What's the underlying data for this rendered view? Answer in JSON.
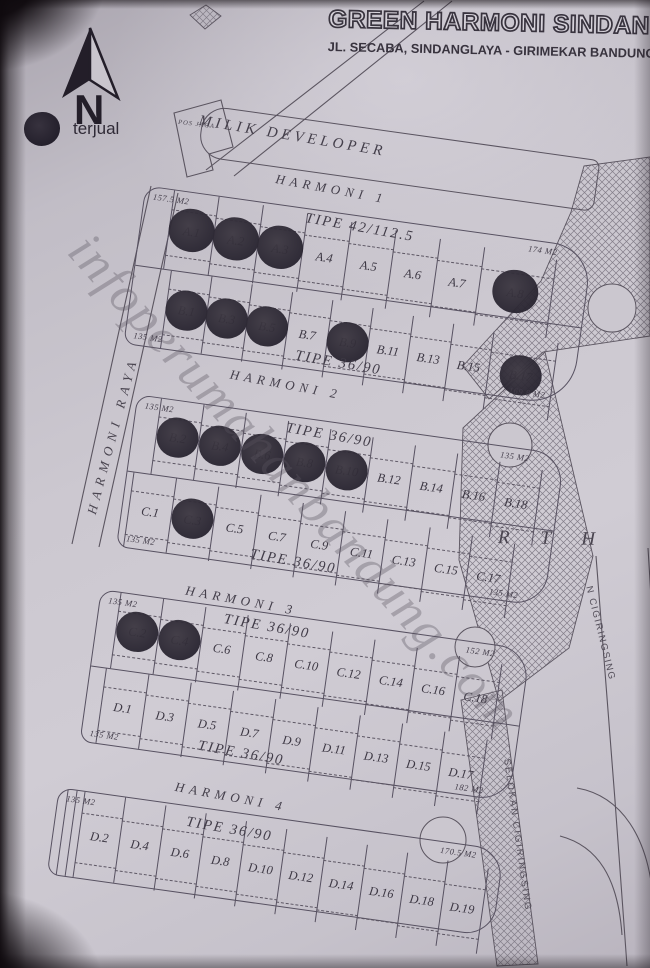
{
  "header": {
    "title": "GREEN HARMONI SINDANGLAYA",
    "subtitle": "JL. SECABA, SINDANGLAYA - GIRIMEKAR BANDUNG"
  },
  "compass": {
    "label": "N"
  },
  "legend": {
    "sold": "terjual"
  },
  "watermark": "infoperumahanbandung.com",
  "landmarks": {
    "pos_jaga": "POS JAGA",
    "developer_strip": "MILIK DEVELOPER",
    "left_road": "HARMONI RAYA",
    "green_space": "R T H",
    "right_road": "N CIGIRINGSING",
    "drain": "SELOKAN CIGIRINGSING"
  },
  "blocks": [
    {
      "street": "HARMONI 1",
      "rows": [
        {
          "tipe": "TIPE 42/112.5",
          "area_left": "157.5 M2",
          "area_right": "174 M2",
          "plots": [
            {
              "label": "A.1",
              "sold": true
            },
            {
              "label": "A.2",
              "sold": true
            },
            {
              "label": "A.3",
              "sold": true
            },
            {
              "label": "A.4",
              "sold": false
            },
            {
              "label": "A.5",
              "sold": false
            },
            {
              "label": "A.6",
              "sold": false
            },
            {
              "label": "A.7",
              "sold": false
            },
            {
              "label": "A.8",
              "sold": true
            }
          ]
        },
        {
          "tipe": "TIPE 36/90",
          "area_left": "135 M2",
          "area_right": "169.8 M2",
          "plots": [
            {
              "label": "B.1",
              "sold": true
            },
            {
              "label": "B.3",
              "sold": true
            },
            {
              "label": "B.5",
              "sold": true
            },
            {
              "label": "B.7",
              "sold": false
            },
            {
              "label": "B.9",
              "sold": true
            },
            {
              "label": "B.11",
              "sold": false
            },
            {
              "label": "B.13",
              "sold": false
            },
            {
              "label": "B.15",
              "sold": false
            },
            {
              "label": "B.17",
              "sold": true
            }
          ]
        }
      ]
    },
    {
      "street": "HARMONI 2",
      "rows": [
        {
          "tipe": "TIPE 36/90",
          "area_left": "135 M2",
          "area_right": "135 M2",
          "plots": [
            {
              "label": "B.2",
              "sold": true
            },
            {
              "label": "B.4",
              "sold": true
            },
            {
              "label": "B.6",
              "sold": true
            },
            {
              "label": "B.8",
              "sold": true
            },
            {
              "label": "B.10",
              "sold": true
            },
            {
              "label": "B.12",
              "sold": false
            },
            {
              "label": "B.14",
              "sold": false
            },
            {
              "label": "B.16",
              "sold": false
            },
            {
              "label": "B.18",
              "sold": false
            }
          ]
        },
        {
          "tipe": "TIPE 36/90",
          "area_left": "135 M2",
          "area_right": "135 M2",
          "plots": [
            {
              "label": "C.1",
              "sold": false
            },
            {
              "label": "C.3",
              "sold": true
            },
            {
              "label": "C.5",
              "sold": false
            },
            {
              "label": "C.7",
              "sold": false
            },
            {
              "label": "C.9",
              "sold": false
            },
            {
              "label": "C.11",
              "sold": false
            },
            {
              "label": "C.13",
              "sold": false
            },
            {
              "label": "C.15",
              "sold": false
            },
            {
              "label": "C.17",
              "sold": false
            }
          ]
        }
      ]
    },
    {
      "street": "HARMONI 3",
      "rows": [
        {
          "tipe": "TIPE 36/90",
          "area_left": "135 M2",
          "area_right": "152 M2",
          "plots": [
            {
              "label": "C.2",
              "sold": true
            },
            {
              "label": "C.4",
              "sold": true
            },
            {
              "label": "C.6",
              "sold": false
            },
            {
              "label": "C.8",
              "sold": false
            },
            {
              "label": "C.10",
              "sold": false
            },
            {
              "label": "C.12",
              "sold": false
            },
            {
              "label": "C.14",
              "sold": false
            },
            {
              "label": "C.16",
              "sold": false
            },
            {
              "label": "C.18",
              "sold": false
            }
          ]
        },
        {
          "tipe": "TIPE 36/90",
          "area_left": "135 M2",
          "area_right": "182 M2",
          "plots": [
            {
              "label": "D.1",
              "sold": false
            },
            {
              "label": "D.3",
              "sold": false
            },
            {
              "label": "D.5",
              "sold": false
            },
            {
              "label": "D.7",
              "sold": false
            },
            {
              "label": "D.9",
              "sold": false
            },
            {
              "label": "D.11",
              "sold": false
            },
            {
              "label": "D.13",
              "sold": false
            },
            {
              "label": "D.15",
              "sold": false
            },
            {
              "label": "D.17",
              "sold": false
            }
          ]
        }
      ]
    },
    {
      "street": "HARMONI 4",
      "rows": [
        {
          "tipe": "TIPE 36/90",
          "area_left": "135 M2",
          "area_right": "170.5 M2",
          "plots": [
            {
              "label": "D.2",
              "sold": false
            },
            {
              "label": "D.4",
              "sold": false
            },
            {
              "label": "D.6",
              "sold": false
            },
            {
              "label": "D.8",
              "sold": false
            },
            {
              "label": "D.10",
              "sold": false
            },
            {
              "label": "D.12",
              "sold": false
            },
            {
              "label": "D.14",
              "sold": false
            },
            {
              "label": "D.16",
              "sold": false
            },
            {
              "label": "D.18",
              "sold": false
            },
            {
              "label": "D.19",
              "sold": false
            }
          ]
        }
      ]
    }
  ]
}
